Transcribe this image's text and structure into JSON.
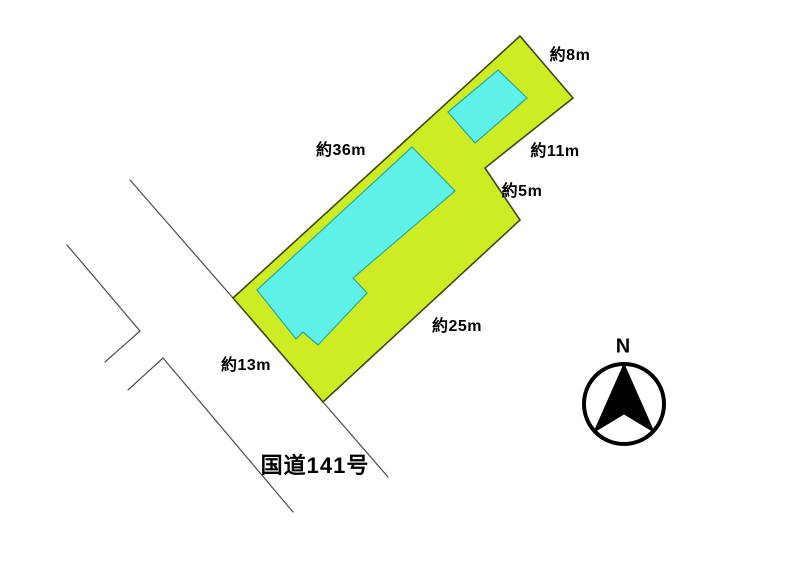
{
  "page": {
    "description": "Land plot survey sketch (real-estate site plan) with parcel outline, building footprints, road edges and north arrow"
  },
  "measurements": {
    "north_short_side": "約8m",
    "northwest_long_side": "約36m",
    "northeast_upper_side": "約11m",
    "notch_side": "約5m",
    "southeast_long_side": "約25m",
    "southwest_short_side": "約13m"
  },
  "road": {
    "name": "国道141号"
  },
  "compass": {
    "north_label": "N"
  },
  "colors": {
    "parcel_fill": "#cdec23",
    "parcel_stroke": "#45450e",
    "building_fill": "#5ff0e8",
    "building_stroke": "#2aa89e",
    "road_line": "#4d4d4d",
    "label_text": "#000000"
  }
}
